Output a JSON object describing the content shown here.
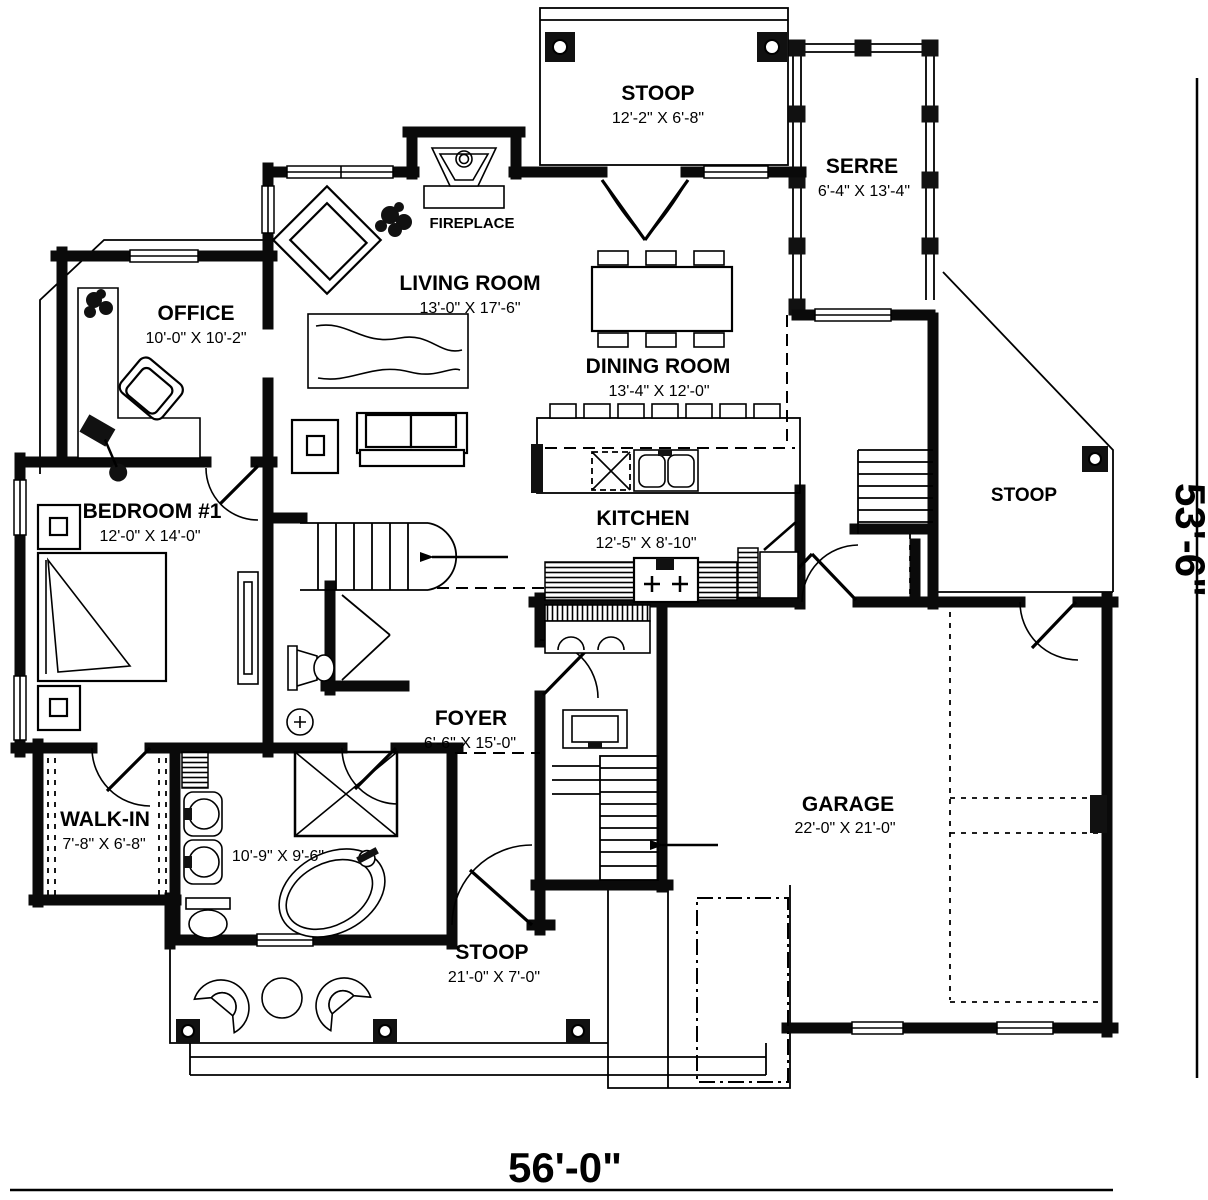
{
  "rooms": {
    "stoop_top": {
      "name": "STOOP",
      "dims": "12'-2\" X 6'-8\""
    },
    "serre": {
      "name": "SERRE",
      "dims": "6'-4\" X 13'-4\""
    },
    "living_room": {
      "name": "LIVING ROOM",
      "dims": "13'-0\" X 17'-6\""
    },
    "office": {
      "name": "OFFICE",
      "dims": "10'-0\" X 10'-2\""
    },
    "dining_room": {
      "name": "DINING ROOM",
      "dims": "13'-4\" X 12'-0\""
    },
    "stoop_right": {
      "name": "STOOP"
    },
    "bedroom_1": {
      "name": "BEDROOM #1",
      "dims": "12'-0\" X 14'-0\""
    },
    "kitchen": {
      "name": "KITCHEN",
      "dims": "12'-5\" X 8'-10\""
    },
    "foyer": {
      "name": "FOYER",
      "dims": "6'-6\" X 15'-0\""
    },
    "walk_in": {
      "name": "WALK-IN",
      "dims": "7'-8\" X 6'-8\""
    },
    "bathroom": {
      "dims": "10'-9\" X 9'-6\""
    },
    "garage": {
      "name": "GARAGE",
      "dims": "22'-0\" X 21'-0\""
    },
    "stoop_bottom": {
      "name": "STOOP",
      "dims": "21'-0\" X 7'-0\""
    }
  },
  "labels": {
    "fireplace": "FIREPLACE"
  },
  "overall_dimensions": {
    "width": "56'-0\"",
    "height": "53'-6\""
  },
  "colors": {
    "ink": "#000000",
    "paper": "#ffffff"
  }
}
